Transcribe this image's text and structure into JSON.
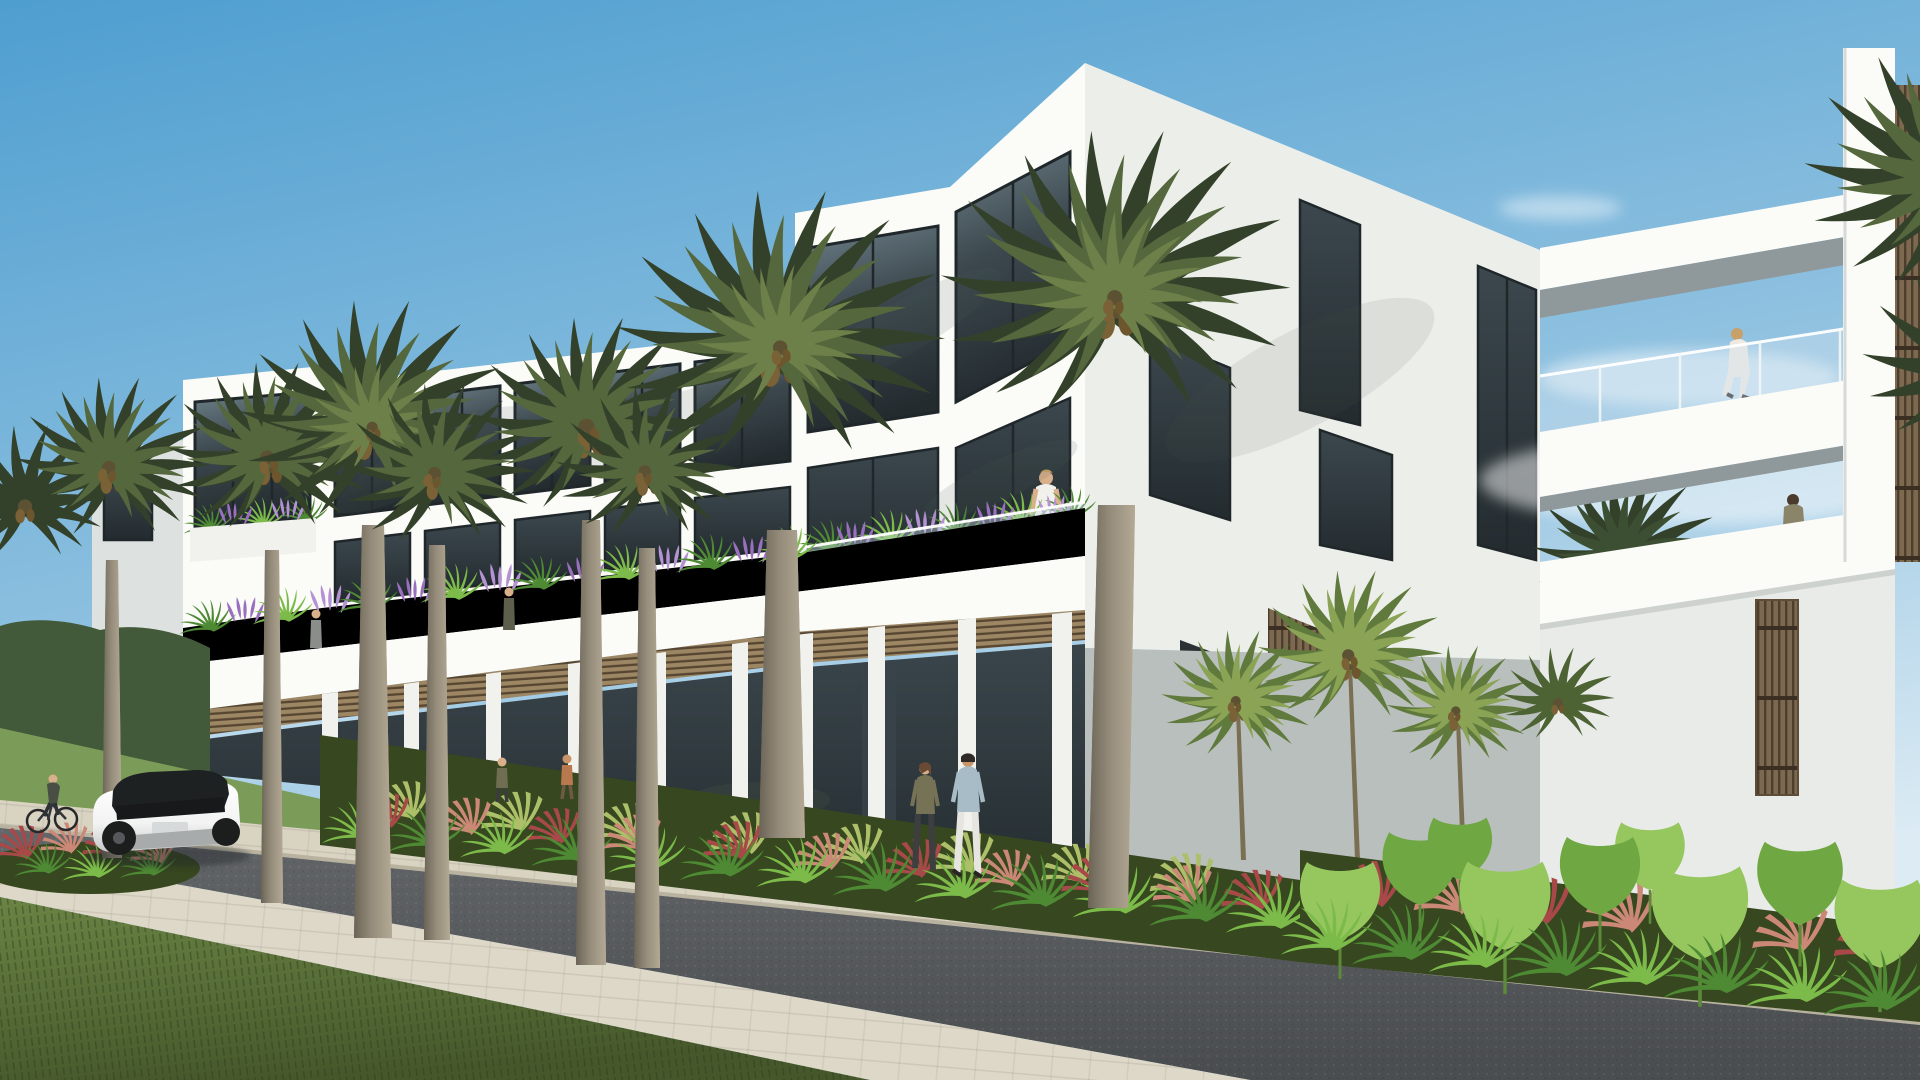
{
  "meta": {
    "title": "Architectural rendering: modern white three-story mixed-use building lined with tall palm trees along a sunny street",
    "scene_type": "3D architectural visualization",
    "setting": "tropical boulevard with retail ground floor and residential terraces",
    "lighting": "bright midday sun from the right, clear sky",
    "camera": "street-level perspective looking down the block"
  },
  "palette": {
    "sky_top": "#4e9ed0",
    "sky_mid": "#8fc1e0",
    "sky_low": "#dcebf4",
    "white_sun": "#fbfbf8",
    "white": "#f1f2ee",
    "white_shade": "#dde1df",
    "white_dim": "#eceeea",
    "soffit": "#8f999c",
    "frame_dark": "#20272b",
    "glass_hi": "#6d7f88",
    "glass_mid": "#3c484e",
    "glass_dark": "#232b2f",
    "rail_glass": "#cfe2ee",
    "louver": "#9c8663",
    "louver_dark": "#564631",
    "wood": "#7d6950",
    "wood_dark": "#4d3f2e",
    "trunk": "#948b7a",
    "trunk_dark": "#6b6456",
    "palm_dark": "#33412a",
    "palm_mid": "#55673c",
    "palm_light": "#6d8049",
    "areca_light": "#8aa355",
    "areca_dark": "#5f7a3c",
    "fern_light": "#7cbb4a",
    "fern_dark": "#4e8a34",
    "grass_tuft": "#aebf6a",
    "ground_cover": "#37471f",
    "ear_light": "#96c75e",
    "ear_mid": "#6fa742",
    "red_plume": "#a84848",
    "pink_plume": "#cc8877",
    "purple": "#9b6fc0",
    "purple_light": "#b592d4",
    "lawn": "#7b9b58",
    "hedge": "#42593a",
    "grass_hi": "#6b8444",
    "grass_lo": "#46582b",
    "paver": "#d9d3c2",
    "paver_near": "#ded8c8",
    "paver_edge": "#b8b29f",
    "road_hi": "#64676a",
    "road_lo": "#4b4e51",
    "car_white": "#f2f3f2",
    "car_dark": "#1e2122",
    "skin": "#d9b08c",
    "shadow": "#4a5a52"
  },
  "scene": {
    "sky": {
      "label": "clear blue sky",
      "clouds": "faint white wisps near the rooflines"
    },
    "architecture": {
      "style": "modern tropical minimalist",
      "stories": "two to three stories, flat roofs",
      "materials": [
        "white stucco",
        "dark tinted glazing",
        "wood louver transoms",
        "frameless glass railings"
      ],
      "left_tower": "small white corner tower with tall tinted glazing and flower planter",
      "long_retail_block": "two-story retail block with louvered transom band and dark storefronts",
      "tall_corner_block": "three-story corner volume with large tinted windows and planted balcony",
      "side_elevation": "sunlit side wall with staggered windows and louvered vent",
      "sky_bridges": "two white sky bridges with glass railings spanning the courtyard",
      "wood_screens": "vertical wood slat screens at the right wing"
    },
    "landscape": {
      "street_palms": 8,
      "areca_palms": 4,
      "balcony_planters": "terrace planters overflowing with grasses and purple flowers",
      "street_beds": "bright ferns, red fountain grass and yellow-green tufts along the walkway",
      "right_jungle": "dense bed of elephant-ear leaves, ferns and red grasses",
      "foreground": "mown green verge beside the sidewalk"
    },
    "street": {
      "road": "dark asphalt roadway",
      "far_walkway": "light paver walkway with raised curb at the planting beds",
      "near_sidewalk": "light paver sidewalk strip",
      "grass": "green grass verge in the foreground"
    },
    "vehicles": {
      "car": "white SUV with black roof driving away down the street",
      "bicycle": "cyclist riding along the left edge of the road"
    },
    "people": {
      "sidewalk_pair": "man in light blue shirt and woman in olive top walking past the storefronts",
      "storefront_walkers": 2,
      "balcony_residents": 4,
      "bridge_walker": "woman in a white dress crossing the glass-railed bridge",
      "courtyard_visitor": "person with a shoulder bag at the courtyard terrace"
    }
  }
}
